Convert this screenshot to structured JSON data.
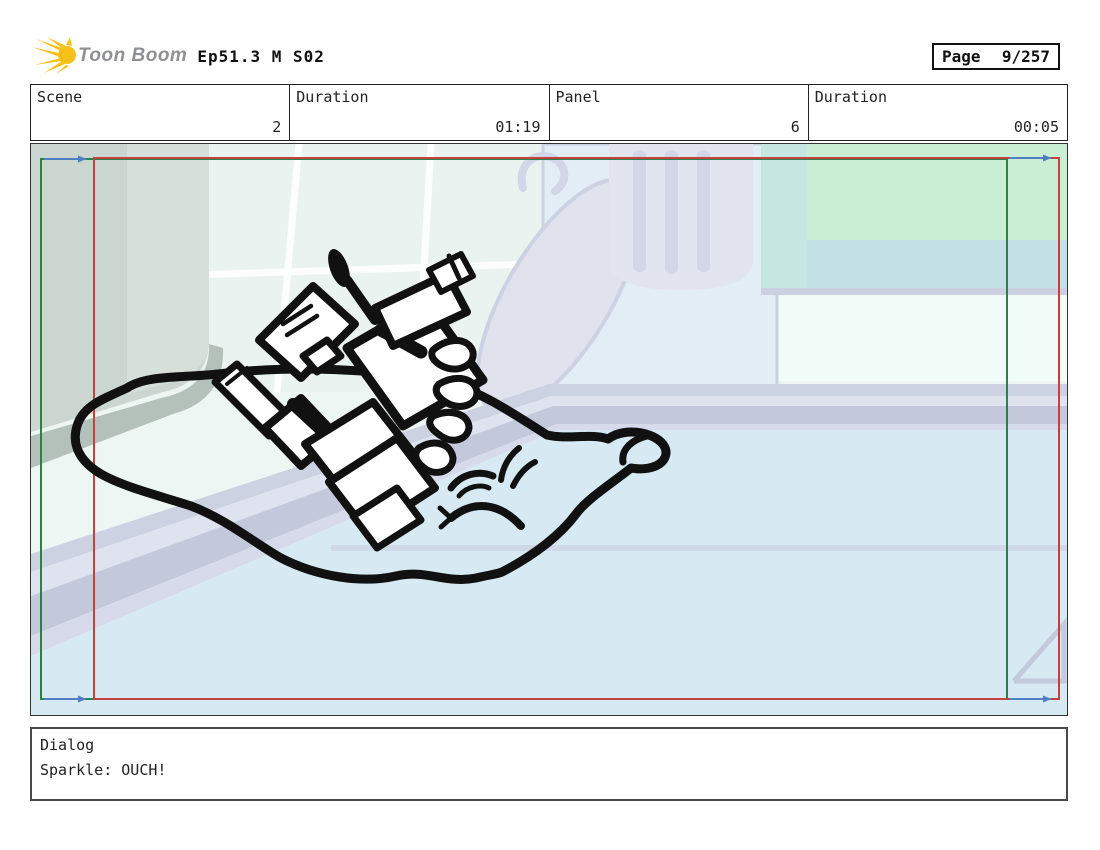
{
  "header": {
    "logo_text": "Toon Boom",
    "title": "Ep51.3 M S02",
    "page_label": "Page",
    "page_value": "9/257"
  },
  "info_table": {
    "cells": [
      {
        "label": "Scene",
        "value": "2"
      },
      {
        "label": "Duration",
        "value": "01:19"
      },
      {
        "label": "Panel",
        "value": "6"
      },
      {
        "label": "Duration",
        "value": "00:05"
      }
    ]
  },
  "dialog": {
    "label": "Dialog",
    "line": "Sparkle: OUCH!"
  },
  "colors": {
    "camera_start_frame": "#2e8049",
    "camera_end_frame": "#bf4340",
    "camera_arrow": "#4f7fc2",
    "logo_yellow": "#f6c21a",
    "logo_text_gray": "#8f9094",
    "sketch_ink": "#111111"
  }
}
